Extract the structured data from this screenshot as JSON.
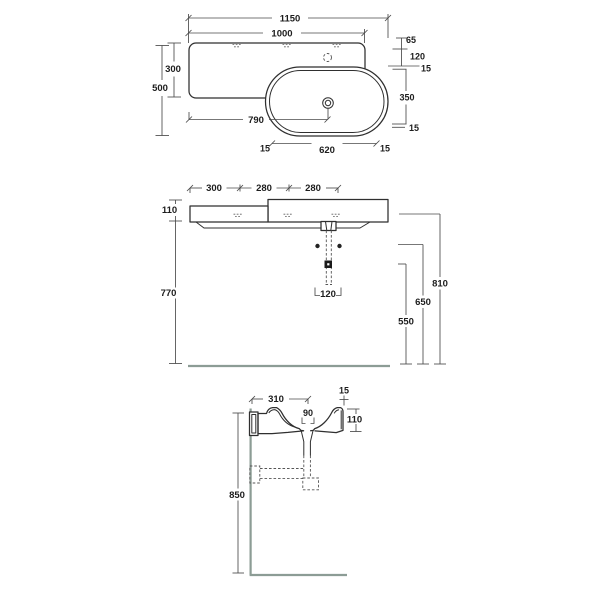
{
  "colors": {
    "ink": "#2f2f2f",
    "floor_line": "#8c9c95"
  },
  "plan_view": {
    "total_width": "1150",
    "unit_width": "1000",
    "left_depth": "300",
    "total_depth": "500",
    "drain_from_left": "790",
    "edge_to_tap": "65",
    "tap_to_basin": "120",
    "rim_top": "15",
    "basin_inner_depth": "350",
    "rim_bottom": "15",
    "rim_left": "15",
    "basin_inner_width": "620",
    "rim_right": "15"
  },
  "front_view": {
    "fix_span_1": "300",
    "fix_span_2": "280",
    "fix_span_3": "280",
    "basin_height": "110",
    "under_height": "770",
    "top_height": "810",
    "bracket_height": "650",
    "waste_height": "550",
    "waste_width": "120"
  },
  "side_view": {
    "wall_to_drain": "310",
    "back_gap": "15",
    "drain_width": "90",
    "basin_height": "110",
    "mount_height": "850"
  }
}
